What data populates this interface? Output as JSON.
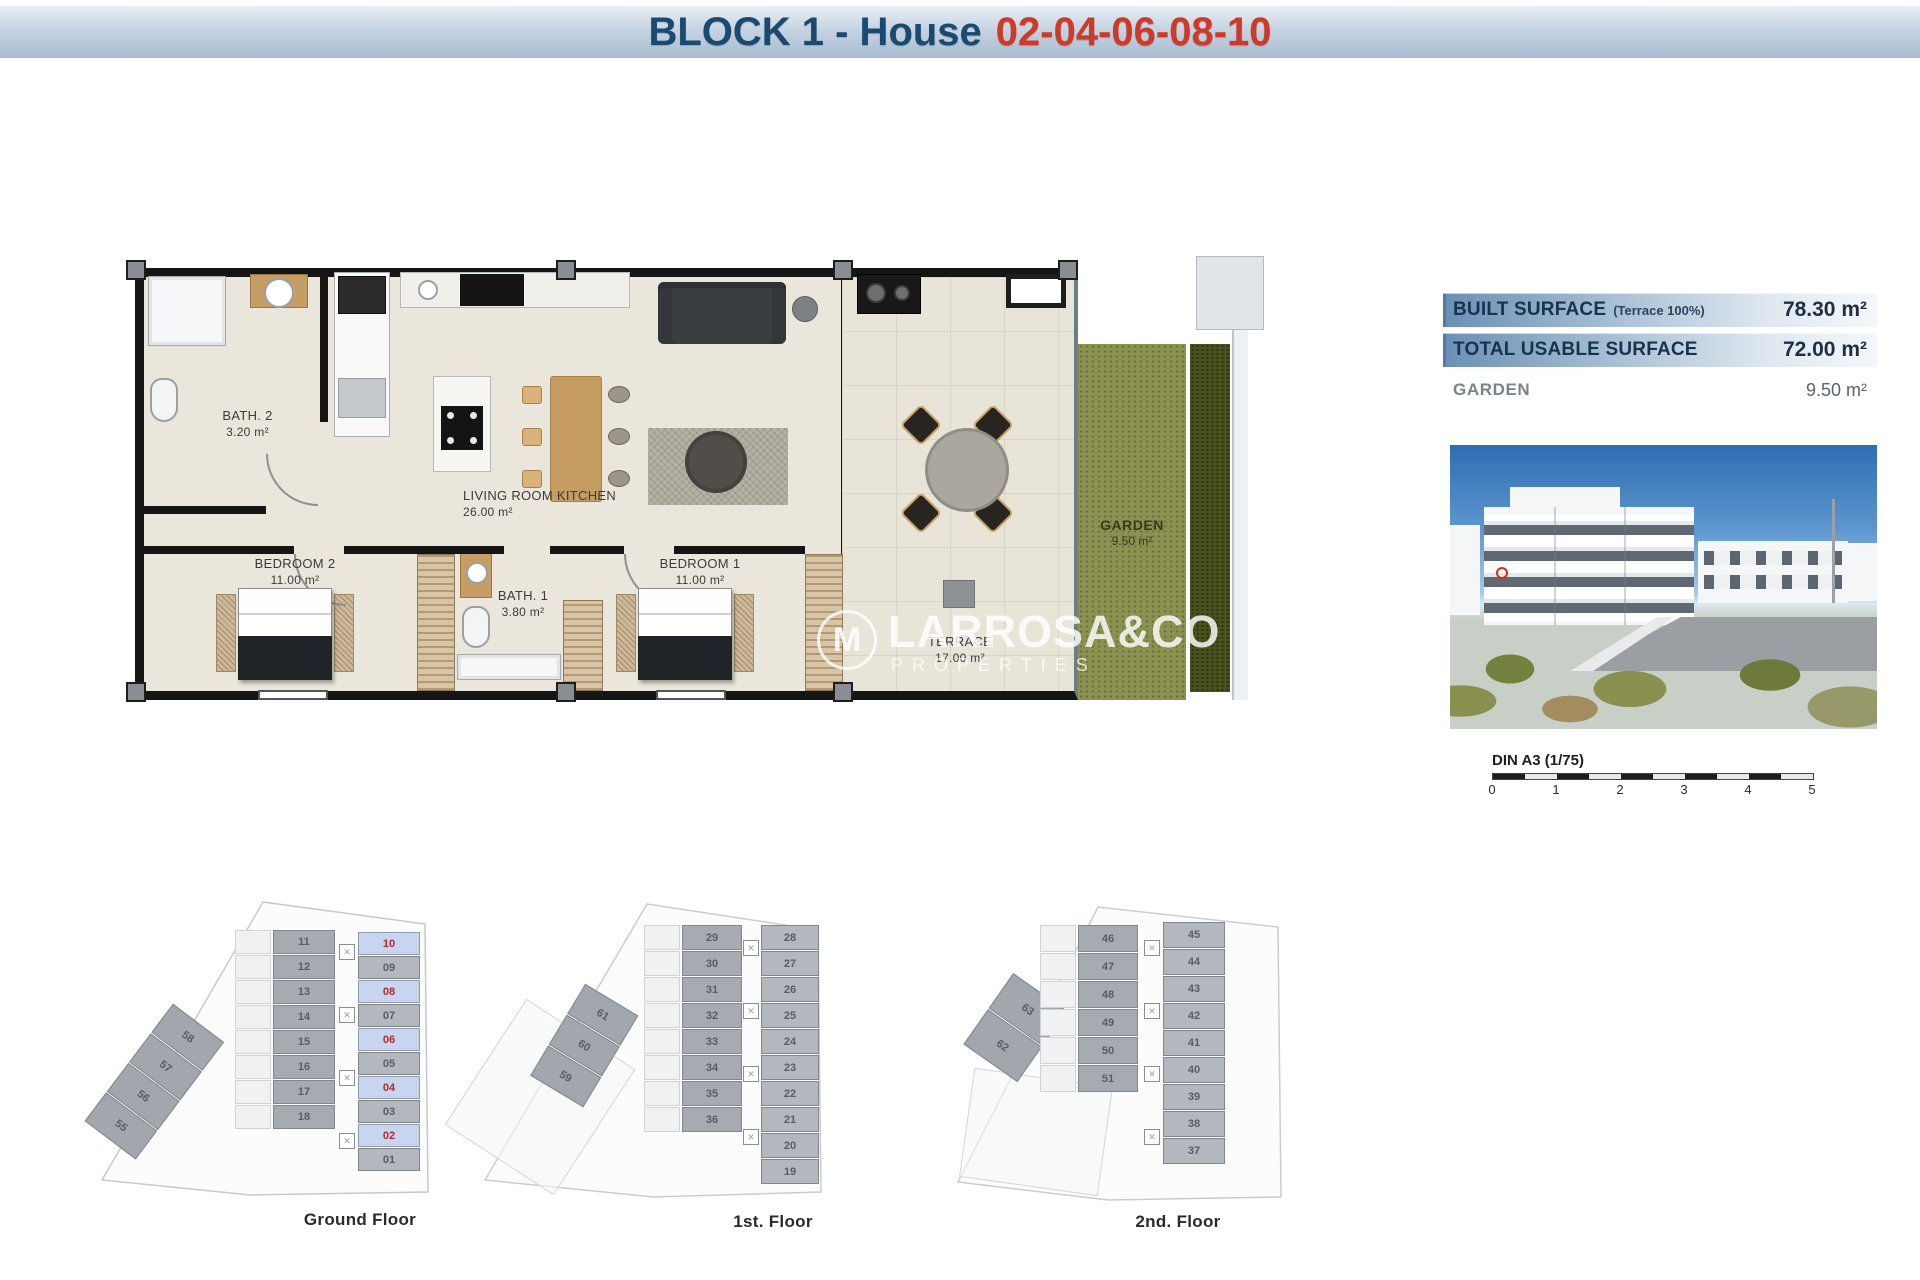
{
  "title": {
    "prefix": "BLOCK 1 - House",
    "numbers": "02-04-06-08-10"
  },
  "colors": {
    "title_navy": "#1a4a70",
    "title_red": "#cf3a28",
    "bar_gradient_start": "#6a8fb4",
    "bar_gradient_end": "#f4f7fa",
    "highlight_unit_bg": "#c9d5ee",
    "highlight_unit_text": "#b3282d",
    "garden_green": "#8b9150",
    "hedge_green": "#48521f"
  },
  "surface_table": {
    "rows": [
      {
        "label": "BUILT SURFACE",
        "note": "(Terrace 100%)",
        "value": "78.30 m²"
      },
      {
        "label": "TOTAL USABLE SURFACE",
        "note": "",
        "value": "72.00 m²"
      },
      {
        "label": "GARDEN",
        "note": "",
        "value": "9.50 m²"
      }
    ]
  },
  "rooms": {
    "bath2": {
      "name": "BATH. 2",
      "area": "3.20 m²"
    },
    "living": {
      "name": "LIVING ROOM KITCHEN",
      "area": "26.00 m²"
    },
    "bedroom2": {
      "name": "BEDROOM 2",
      "area": "11.00 m²"
    },
    "bath1": {
      "name": "BATH. 1",
      "area": "3.80 m²"
    },
    "bedroom1": {
      "name": "BEDROOM 1",
      "area": "11.00 m²"
    },
    "terrace": {
      "name": "TERRACE",
      "area": "17.00 m²"
    },
    "garden": {
      "name": "GARDEN",
      "area": "9.50 m²"
    }
  },
  "watermark": {
    "logo": "M",
    "brand": "LARROSA&CO",
    "sub": "PROPERTIES"
  },
  "scale_bar": {
    "label": "DIN A3 (1/75)",
    "ticks": [
      "0",
      "1",
      "2",
      "3",
      "4",
      "5"
    ]
  },
  "floors": [
    {
      "label": "Ground Floor",
      "diagonal_units": [
        "58",
        "57",
        "56",
        "55"
      ],
      "left_units": [
        "11",
        "12",
        "13",
        "14",
        "15",
        "16",
        "17",
        "18"
      ],
      "right_units": [
        "10",
        "09",
        "08",
        "07",
        "06",
        "05",
        "04",
        "03",
        "02",
        "01"
      ],
      "highlighted_units": [
        "10",
        "08",
        "06",
        "04",
        "02"
      ]
    },
    {
      "label": "1st. Floor",
      "diagonal_units": [
        "61",
        "60",
        "59"
      ],
      "left_units": [
        "29",
        "30",
        "31",
        "32",
        "33",
        "34",
        "35",
        "36"
      ],
      "right_units": [
        "28",
        "27",
        "26",
        "25",
        "24",
        "23",
        "22",
        "21",
        "20",
        "19"
      ],
      "highlighted_units": []
    },
    {
      "label": "2nd. Floor",
      "diagonal_units": [
        "63",
        "62"
      ],
      "left_units": [
        "46",
        "47",
        "48",
        "49",
        "50",
        "51"
      ],
      "right_units": [
        "45",
        "44",
        "43",
        "42",
        "41",
        "40",
        "39",
        "38",
        "37"
      ],
      "highlighted_units": []
    }
  ]
}
